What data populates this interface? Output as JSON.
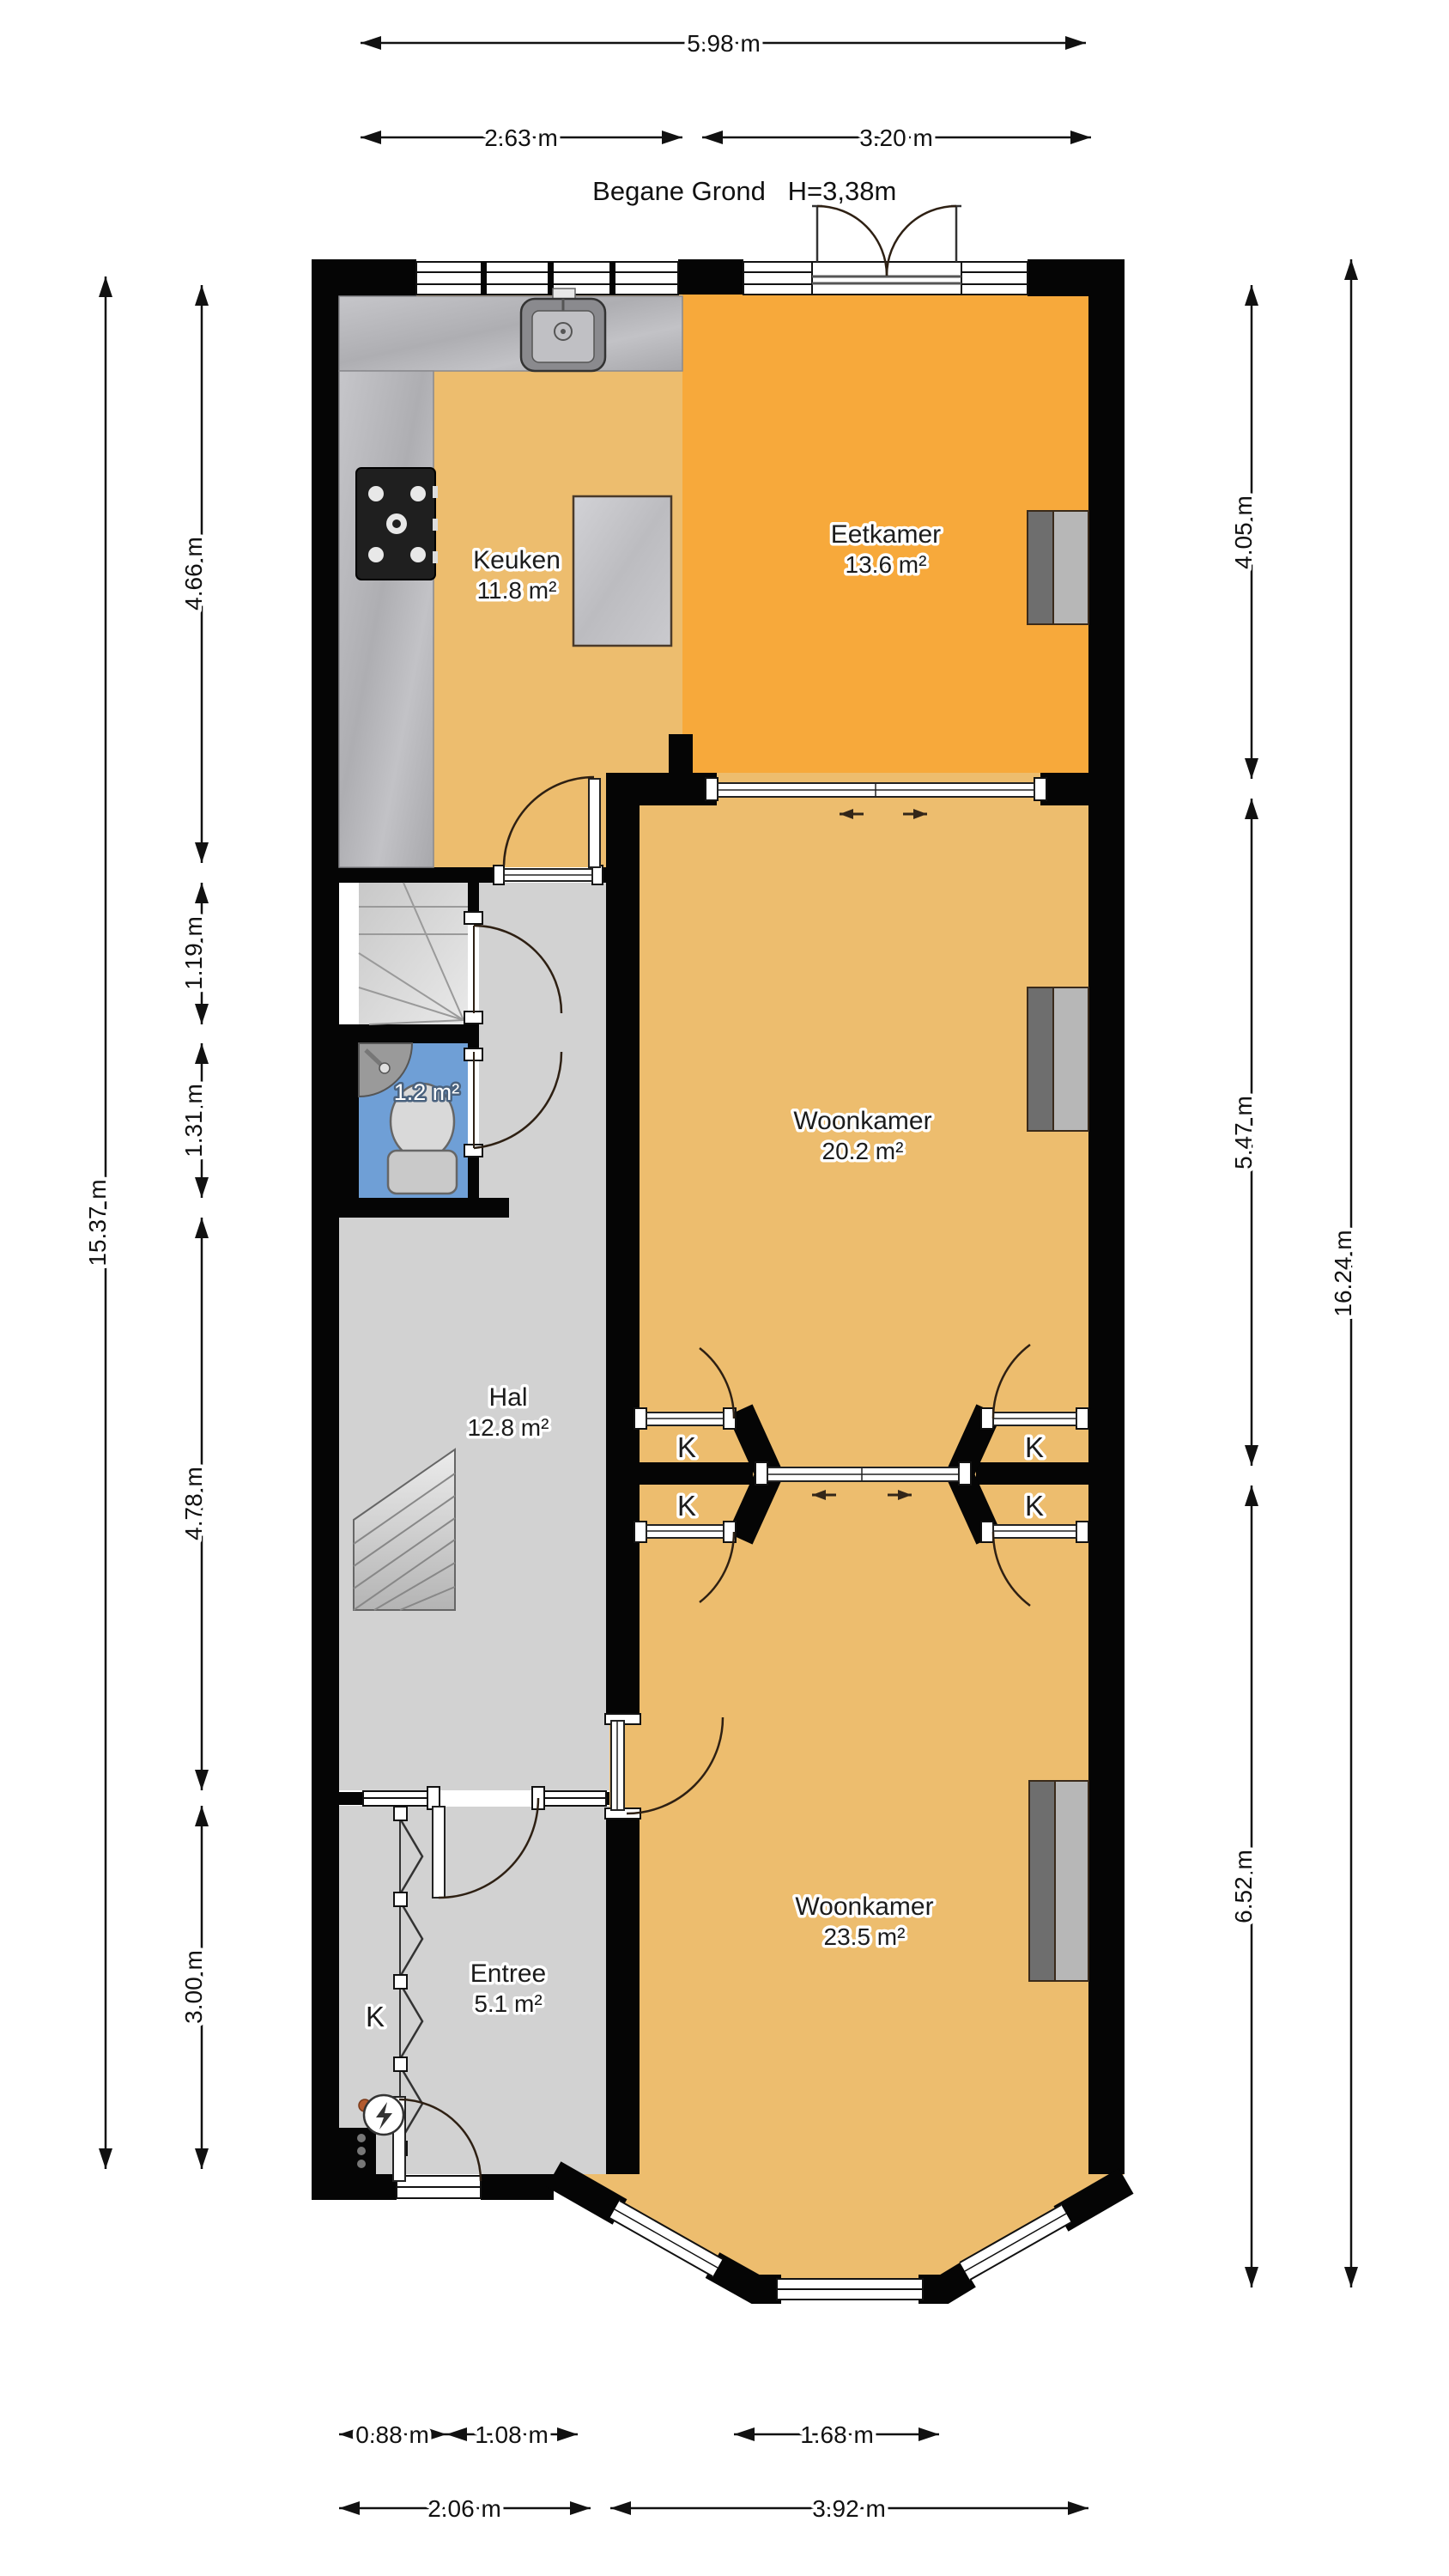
{
  "title": {
    "floor": "Begane Grond",
    "height": "H=3,38m"
  },
  "rooms": [
    {
      "name": "Keuken",
      "area": "11.8 m²"
    },
    {
      "name": "Eetkamer",
      "area": "13.6 m²"
    },
    {
      "name": "Woonkamer",
      "area": "20.2 m²"
    },
    {
      "name": "Hal",
      "area": "12.8 m²"
    },
    {
      "name": "",
      "area": "1.2 m²"
    },
    {
      "name": "Entree",
      "area": "5.1 m²"
    },
    {
      "name": "Woonkamer",
      "area": "23.5 m²"
    }
  ],
  "closets": {
    "left_top": "K",
    "left_bottom": "K",
    "right_top": "K",
    "right_bottom": "K",
    "entree": "K"
  },
  "dims": {
    "top": [
      "5.98 m",
      "2.63 m",
      "3.20 m"
    ],
    "left": [
      "15.37 m",
      "4.66 m",
      "1.19 m",
      "1.31 m",
      "4.78 m",
      "3.00 m"
    ],
    "right": [
      "4.05 m",
      "5.47 m",
      "6.52 m",
      "16.24 m"
    ],
    "bottom": [
      "0.88 m",
      "1.08 m",
      "1.68 m",
      "2.06 m",
      "3.92 m"
    ]
  },
  "colors": {
    "floor_tan": "#edbd6e",
    "floor_orange": "#f7a93b",
    "floor_gray": "#d2d2d2",
    "floor_blue": "#6f9fd6",
    "wall_black": "#050505",
    "counter_gray": "#b9b9bd",
    "radiator_dark": "#6e6e6e",
    "radiator_light": "#b7b7b7"
  }
}
